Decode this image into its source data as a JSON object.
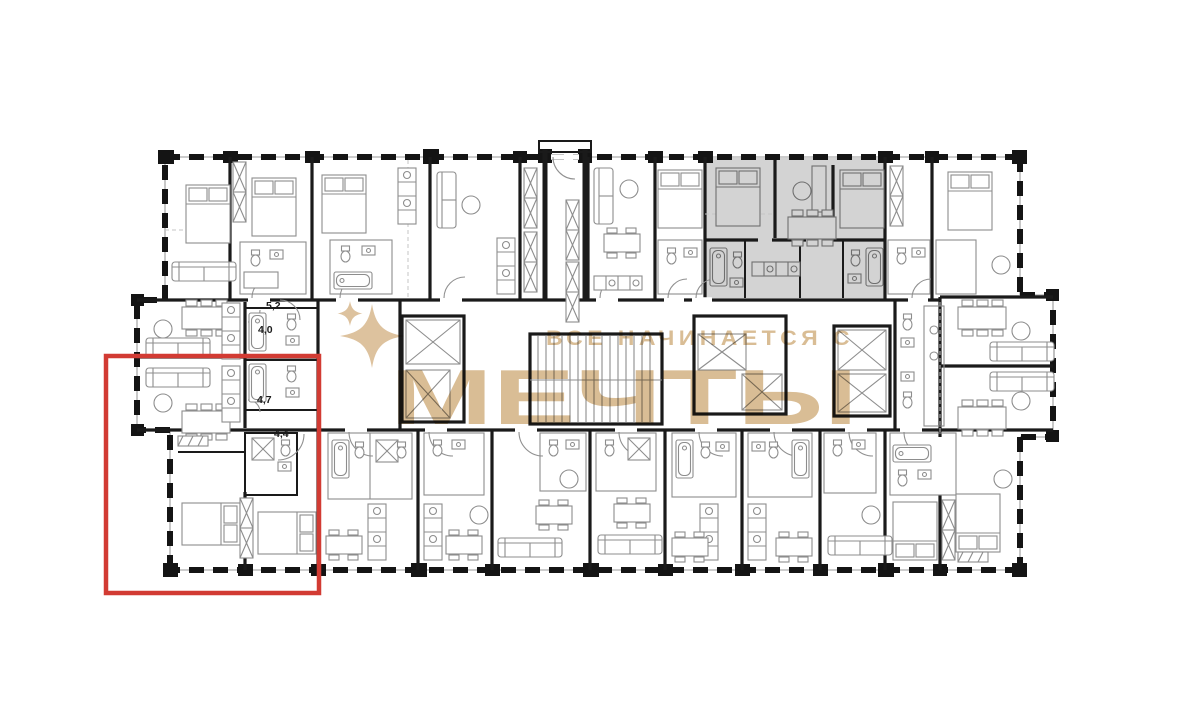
{
  "watermark": {
    "line1": "ВСЕ НАЧИНАЕТСЯ С",
    "line2": "МЕЧТЫ",
    "icon": "sparkle-icon",
    "color": "#d9bd95"
  },
  "highlight": {
    "selected_unit_outline_color": "#d23b33",
    "featured_unit_fill": "#d3d3d3"
  },
  "plan": {
    "wall_color": "#1a1a1a",
    "furniture_color": "#8d8d8d",
    "dimension_labels": [
      {
        "text": "5,2"
      },
      {
        "text": "4,0"
      },
      {
        "text": "4,7"
      },
      {
        "text": "4,4"
      }
    ]
  }
}
